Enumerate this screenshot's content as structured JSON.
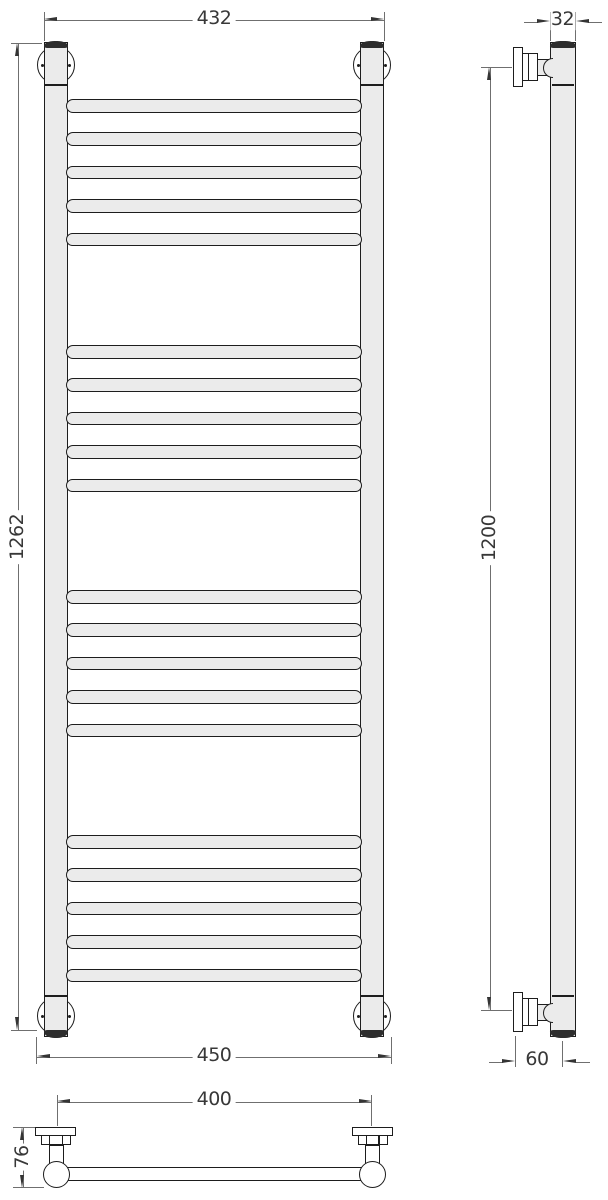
{
  "dimensions": {
    "front_top_width": "432",
    "front_height": "1262",
    "front_bottom_width": "450",
    "tube_diameter": "32",
    "side_height": "1200",
    "wall_to_tube_axis": "60",
    "bracket_center_spacing": "400",
    "bracket_depth": "76"
  },
  "front_view": {
    "rung_count": 20,
    "rungs_per_group": 5,
    "rung_tops_px": [
      99,
      132.4,
      165.8,
      199.2,
      232.6,
      345,
      378.4,
      411.8,
      445.2,
      478.6,
      590,
      623.4,
      656.8,
      690.2,
      723.6,
      835,
      868.4,
      901.8,
      935.2,
      968.6
    ]
  },
  "colors": {
    "metal_fill": "#ebebeb",
    "outline": "#1d1d1d",
    "dim_line": "#6f6f6f",
    "dim_arrow": "#343434",
    "dim_text": "#383838",
    "cap_dark": "#2d2d2d",
    "bg": "#ffffff"
  }
}
